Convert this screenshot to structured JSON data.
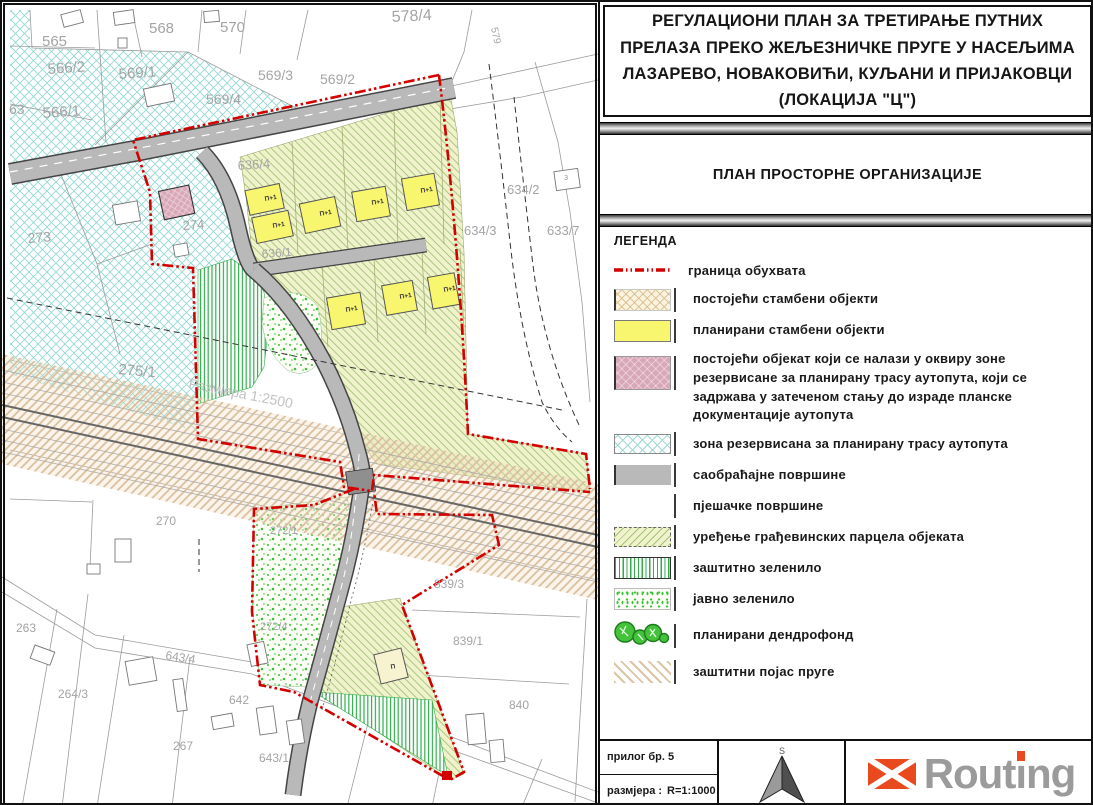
{
  "title_lines": [
    "РЕГУЛАЦИОНИ ПЛАН ЗА ТРЕТИРАЊЕ ПУТНИХ",
    "ПРЕЛАЗА ПРЕКО ЖЕЉЕЗНИЧКЕ ПРУГЕ У НАСЕЉИМА",
    "ЛАЗАРЕВО, НОВАКОВИЋИ, КУЉАНИ И ПРИЈАКОВЦИ",
    "(ЛОКАЦИЈА \"Ц\")"
  ],
  "subtitle": "ПЛАН ПРОСТОРНЕ ОРГАНИЗАЦИЈЕ",
  "legend": {
    "title": "ЛЕГЕНДА",
    "items": [
      {
        "label": "граница обухвата"
      },
      {
        "label": "постојећи стамбени објекти"
      },
      {
        "label": "планирани стамбени објекти"
      },
      {
        "label": "постојећи објекат који се налази у оквиру зоне резервисане за планирану трасу аутопута, који се задржава у затеченом стању до израде планске документације аутопута"
      },
      {
        "label": "зона резервисана за планирану трасу аутопута"
      },
      {
        "label": "саобраћајне површине"
      },
      {
        "label": "пјешачке површине"
      },
      {
        "label": "уређење грађевинских парцела објеката"
      },
      {
        "label": "заштитно зеленило"
      },
      {
        "label": "јавно зеленило"
      },
      {
        "label": "планирани дендрофонд"
      },
      {
        "label": "заштитни појас пруге"
      }
    ]
  },
  "footer": {
    "attachment": "прилог бр. 5",
    "scale_label": "размјера :",
    "scale_value": "R=1:1000",
    "north_letter": "S",
    "logo_text": "Routing"
  },
  "colors": {
    "boundary_red": "#d40000",
    "planned_yellow": "#f8f56e",
    "existing_pink": "#d9a8b8",
    "zone_cyan": "#8fd4cf",
    "road_gray": "#b9b9b9",
    "green_hatch": "#2fae4a",
    "public_green": "#3cbf3c",
    "rail_beige": "#dcc09e",
    "logo_orange": "#e8491d",
    "logo_gray": "#9b9b9b"
  },
  "map": {
    "parcel_labels": [
      {
        "t": "578/4",
        "x": 390,
        "y": 20,
        "s": 16,
        "r": -3
      },
      {
        "t": "565",
        "x": 40,
        "y": 44,
        "s": 15,
        "r": 0
      },
      {
        "t": "568",
        "x": 147,
        "y": 31,
        "s": 15,
        "r": 0
      },
      {
        "t": "570",
        "x": 218,
        "y": 30,
        "s": 15,
        "r": 0
      },
      {
        "t": "566/2",
        "x": 46,
        "y": 72,
        "s": 15,
        "r": -4
      },
      {
        "t": "569/1",
        "x": 117,
        "y": 77,
        "s": 15,
        "r": -4
      },
      {
        "t": "569/3",
        "x": 256,
        "y": 78,
        "s": 14,
        "r": 0
      },
      {
        "t": "569/2",
        "x": 318,
        "y": 82,
        "s": 14,
        "r": 0
      },
      {
        "t": "569/4",
        "x": 204,
        "y": 102,
        "s": 14,
        "r": 0
      },
      {
        "t": "63",
        "x": 7,
        "y": 112,
        "s": 14,
        "r": 0
      },
      {
        "t": "566/1",
        "x": 41,
        "y": 116,
        "s": 15,
        "r": -4
      },
      {
        "t": "273",
        "x": 26,
        "y": 241,
        "s": 14,
        "r": -4
      },
      {
        "t": "274",
        "x": 181,
        "y": 228,
        "s": 13,
        "r": -4
      },
      {
        "t": "636/4",
        "x": 236,
        "y": 168,
        "s": 13,
        "r": -4
      },
      {
        "t": "636/1",
        "x": 260,
        "y": 256,
        "s": 12,
        "r": -4
      },
      {
        "t": "275/1",
        "x": 116,
        "y": 372,
        "s": 15,
        "r": 5
      },
      {
        "t": "579",
        "x": 489,
        "y": 26,
        "s": 10,
        "r": 78
      },
      {
        "t": "634/2",
        "x": 505,
        "y": 192,
        "s": 13,
        "r": 0
      },
      {
        "t": "з",
        "x": 562,
        "y": 178,
        "s": 9,
        "r": 0
      },
      {
        "t": "634/3",
        "x": 462,
        "y": 233,
        "s": 13,
        "r": 0
      },
      {
        "t": "633/7",
        "x": 545,
        "y": 233,
        "s": 13,
        "r": 0
      },
      {
        "t": "270",
        "x": 154,
        "y": 523,
        "s": 12,
        "r": 0
      },
      {
        "t": "272/1",
        "x": 268,
        "y": 532,
        "s": 11,
        "r": 0
      },
      {
        "t": "839/3",
        "x": 432,
        "y": 586,
        "s": 12,
        "r": 0
      },
      {
        "t": "839/1",
        "x": 451,
        "y": 643,
        "s": 12,
        "r": 0
      },
      {
        "t": "840",
        "x": 507,
        "y": 707,
        "s": 12,
        "r": 0
      },
      {
        "t": "263",
        "x": 14,
        "y": 630,
        "s": 12,
        "r": 0
      },
      {
        "t": "272/4",
        "x": 258,
        "y": 628,
        "s": 11,
        "r": 0
      },
      {
        "t": "264/3",
        "x": 56,
        "y": 696,
        "s": 12,
        "r": 0
      },
      {
        "t": "267",
        "x": 171,
        "y": 748,
        "s": 12,
        "r": 0
      },
      {
        "t": "642",
        "x": 227,
        "y": 702,
        "s": 12,
        "r": 0
      },
      {
        "t": "643/4",
        "x": 163,
        "y": 657,
        "s": 12,
        "r": 9
      },
      {
        "t": "643/1",
        "x": 257,
        "y": 760,
        "s": 12,
        "r": 0
      }
    ],
    "underlay_note": {
      "t": "Размјера 1:2500",
      "x": 186,
      "y": 386,
      "s": 14,
      "r": 11
    },
    "building_labels": [
      {
        "t": "П+1",
        "x": 263,
        "y": 199
      },
      {
        "t": "П+1",
        "x": 271,
        "y": 226
      },
      {
        "t": "П+1",
        "x": 318,
        "y": 214
      },
      {
        "t": "П+1",
        "x": 370,
        "y": 203
      },
      {
        "t": "П+1",
        "x": 419,
        "y": 191
      },
      {
        "t": "П+1",
        "x": 344,
        "y": 310
      },
      {
        "t": "П+1",
        "x": 398,
        "y": 297
      },
      {
        "t": "П+1",
        "x": 442,
        "y": 290
      },
      {
        "t": "П",
        "x": 389,
        "y": 667
      }
    ]
  }
}
